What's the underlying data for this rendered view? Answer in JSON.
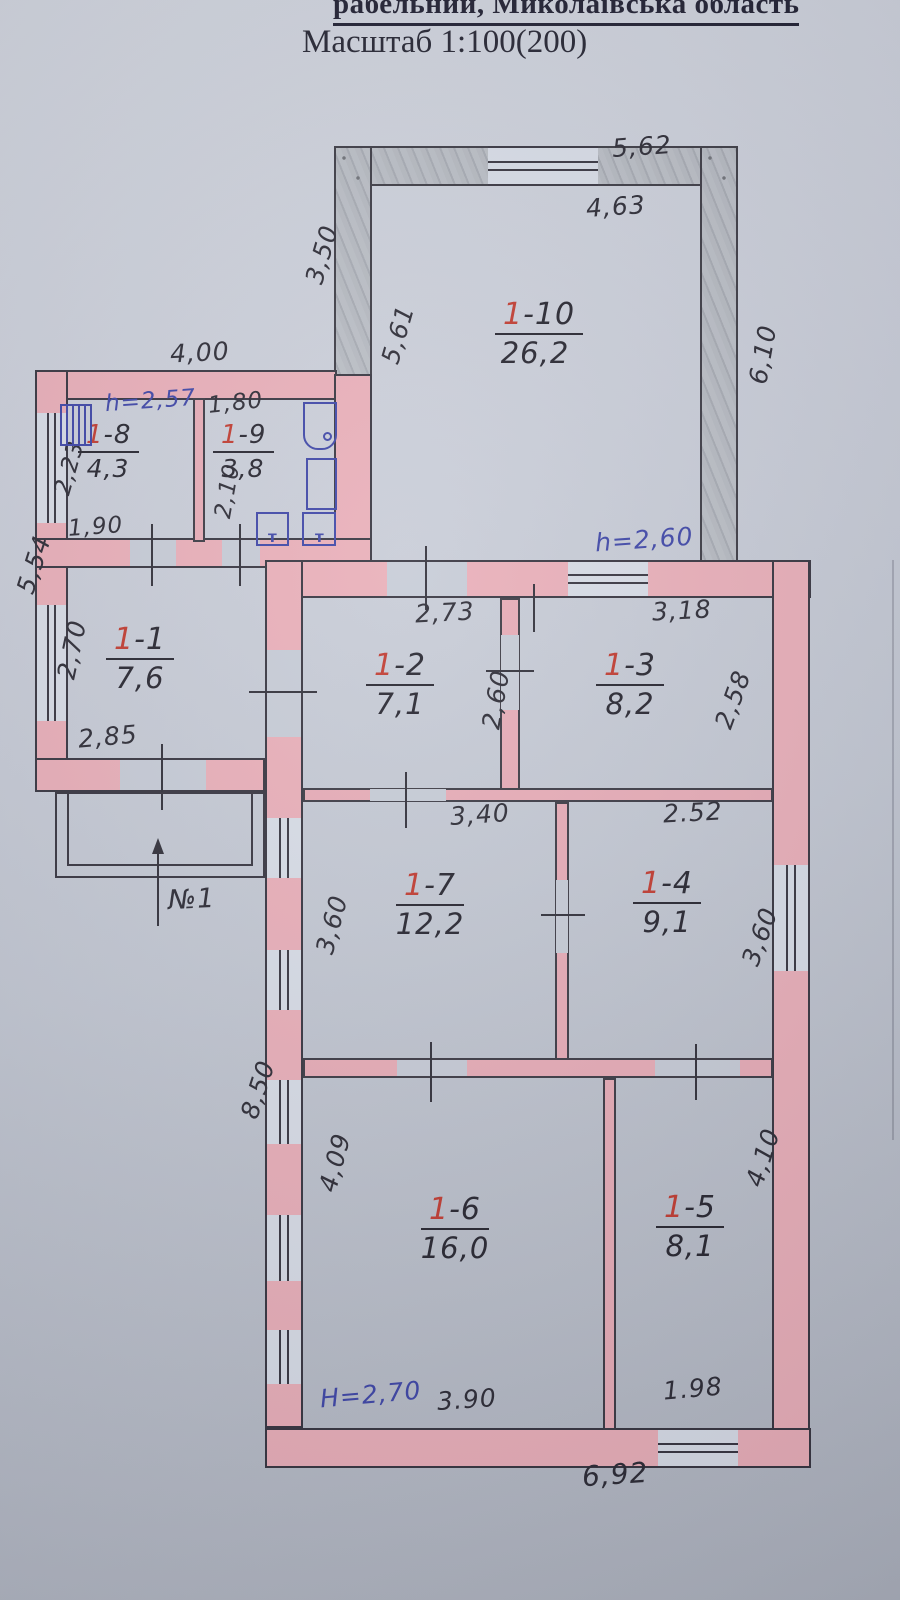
{
  "header": {
    "title_line1": "рабельний,      Миколаївська область",
    "title_line2": "Масштаб 1:100(200)"
  },
  "rooms": {
    "r110": {
      "p": "1",
      "n": "-10",
      "a": "26,2"
    },
    "r8": {
      "p": "1",
      "n": "-8",
      "a": "4,3"
    },
    "r9": {
      "p": "1",
      "n": "-9",
      "a": "3,8"
    },
    "r1": {
      "p": "1",
      "n": "-1",
      "a": "7,6"
    },
    "r2": {
      "p": "1",
      "n": "-2",
      "a": "7,1"
    },
    "r3": {
      "p": "1",
      "n": "-3",
      "a": "8,2"
    },
    "r7": {
      "p": "1",
      "n": "-7",
      "a": "12,2"
    },
    "r4": {
      "p": "1",
      "n": "-4",
      "a": "9,1"
    },
    "r6": {
      "p": "1",
      "n": "-6",
      "a": "16,0"
    },
    "r5": {
      "p": "1",
      "n": "-5",
      "a": "8,1"
    }
  },
  "dims": {
    "v562": "5,62",
    "v463": "4,63",
    "v350": "3,50",
    "v561": "5,61",
    "v610": "6,10",
    "v400": "4,00",
    "v180": "1,80",
    "v223": "2,23",
    "v210": "2,10",
    "v190": "1,90",
    "v554": "5,54",
    "v270": "2,70",
    "v285": "2,85",
    "v273": "2,73",
    "v260": "2,60",
    "v318": "3,18",
    "v258": "2,58",
    "v340": "3,40",
    "v252": "2.52",
    "v360l": "3,60",
    "v360r": "3,60",
    "v850": "8,50",
    "v409": "4,09",
    "v410": "4,10",
    "v390": "3.90",
    "v198": "1.98",
    "v692": "6,92"
  },
  "heights": {
    "h257": "h=2,57",
    "h260": "h=2,60",
    "H270": "H=2,70"
  },
  "entrance": {
    "label": "№1"
  },
  "fixtures": {
    "toilet_mark": "т"
  },
  "colors": {
    "paper": "#c6cbd6",
    "wall_pink": "#e9aeb8",
    "wall_grey": "#b4b8bf",
    "ink_black": "#2a2933",
    "ink_red": "#c0392e",
    "ink_blue": "#3c44a6"
  }
}
